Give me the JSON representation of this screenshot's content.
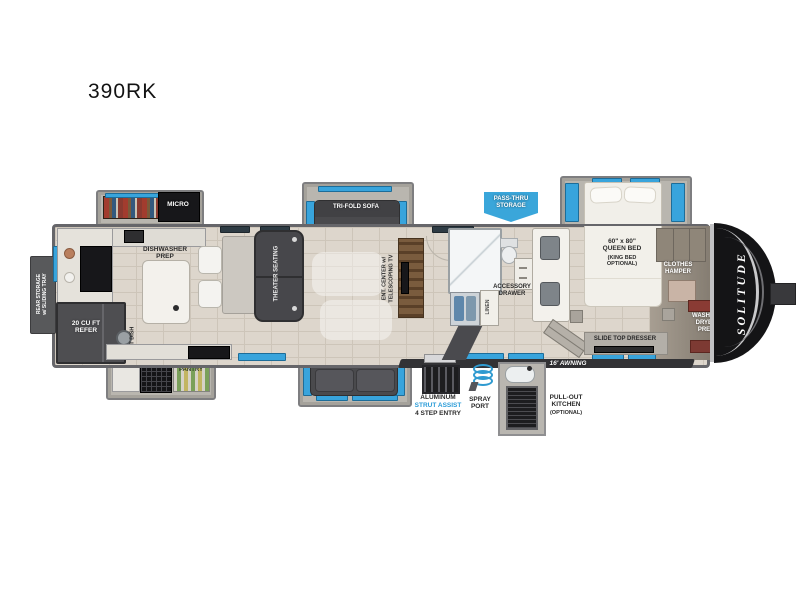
{
  "title": "390RK",
  "colors": {
    "window_blue": "#38a4dc",
    "banner_blue": "#3aa6da",
    "accent_blue": "#2b9cd8",
    "awning_dark": "#323235",
    "cap_black": "#141416",
    "floor_tile": "#ddd6cc"
  },
  "floorplan": {
    "storage": {
      "rear_storage": "REAR STORAGE\nw/ SLIDING TRAY",
      "pass_thru": "PASS-THRU\nSTORAGE"
    },
    "kitchen": {
      "micro": "MICRO",
      "dishwasher_prep": "DISHWASHER\nPREP",
      "refer": "20 CU FT\nREFER",
      "pet_dish": "PET DISH",
      "pantry": "PANTRY"
    },
    "living": {
      "sofa_top": "TRI-FOLD SOFA",
      "sofa_bottom": "TRI-FOLD SOFA",
      "theater": "THEATER SEATING",
      "ent_center": "ENT. CENTER w/\nTELESCOPING TV"
    },
    "bath": {
      "linen": "LINEN",
      "accessory_drawer": "ACCESSORY\nDRAWER"
    },
    "bedroom": {
      "bed_size": "60\" x 80\"\nQUEEN BED",
      "bed_option": "(KING BED\nOPTIONAL)",
      "dresser": "SLIDE TOP DRESSER",
      "clothes_hamper": "CLOTHES\nHAMPER",
      "washer_dryer": "WASHER/\nDRYER\nPREP"
    },
    "exterior": {
      "awning": "16' AWNING",
      "entry_line1": "ALUMINUM",
      "entry_line2": "STRUT ASSIST",
      "entry_line3": "4 STEP ENTRY",
      "spray_port": "SPRAY\nPORT",
      "pullout_kitchen": "PULL-OUT\nKITCHEN",
      "pullout_optional": "(OPTIONAL)",
      "brand": "SOLITUDE"
    }
  }
}
